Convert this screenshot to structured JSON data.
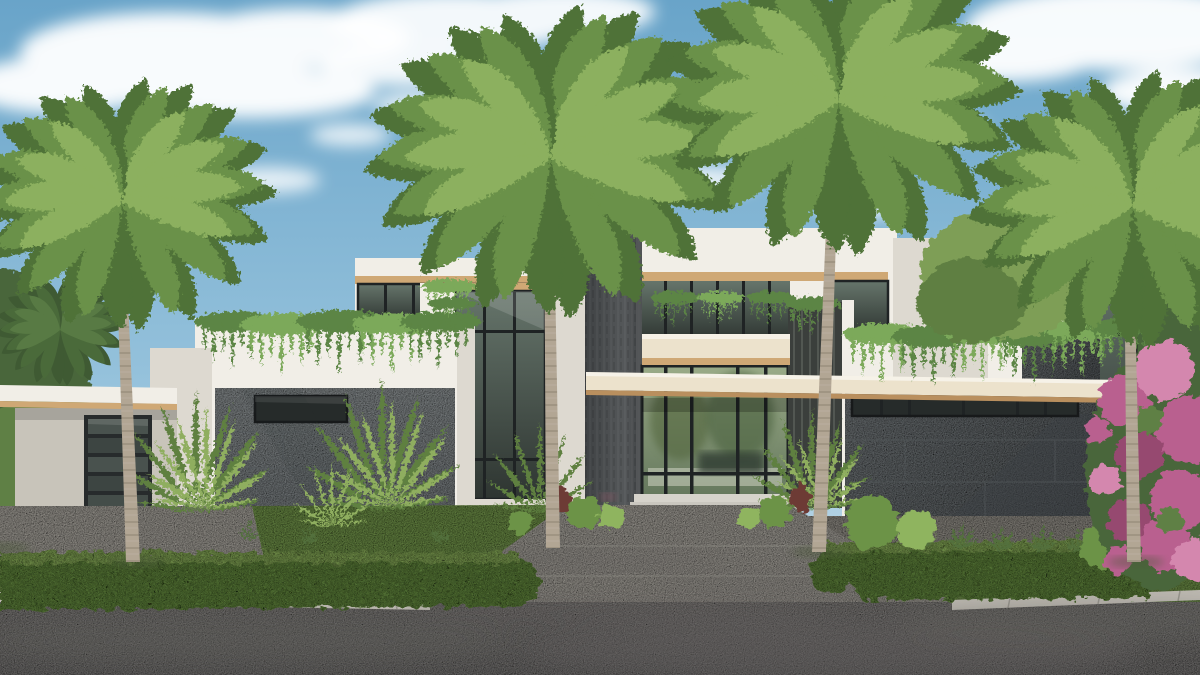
{
  "scene": {
    "type": "architectural-exterior-rendering",
    "description": "Photorealistic 3D rendering of a modern two-story coastal luxury residence with white stucco volumes, gray stone accent walls, a dark central privacy tower, floor-to-ceiling glazing, cream cantilevered canopies, four royal palms, manicured hedges, a central driveway and street in the foreground under a blue sky with scattered clouds.",
    "visible_text": "none",
    "objects": {
      "sky": "blue sky with white cumulus clouds",
      "house": "modern flat-roof two-story residence",
      "privacy_tower": "dark charcoal stone vertical tower at entry",
      "entry_canopy": "long cream cantilevered canopy with wood soffit",
      "balcony": "cream balcony slab over entry glass",
      "garage": "dark glass-paneled garage door under left carport wing",
      "stone_walls": "gray marble-look panel walls left and right",
      "ribbon_window": "horizontal clerestory ribbon window on right wing",
      "glazing": "floor-to-ceiling glass walls with dark mullions",
      "royal_palms": 4,
      "areca_palms": "clusters flanking the left stone wall",
      "vines": "trailing vines over parapets and planters",
      "bougainvillea": "magenta bougainvillea at far right",
      "hedges": "trimmed street hedges left and right",
      "lawn": "manicured lawn",
      "driveway": "light aggregate concrete driveway",
      "street": "asphalt street with palm shadows"
    }
  },
  "palette": {
    "sky_top": "#69a4c9",
    "sky_mid": "#94c1db",
    "sky_low": "#cfe2ec",
    "cloud": "#ffffff",
    "wall_white": "#f1eee7",
    "wall_shade": "#ddd9d0",
    "wall_dark": "#c8c4ba",
    "fascia_cream": "#ece2cc",
    "wood": "#cfa875",
    "wood_dark": "#b98f5e",
    "tower": "#3f4244",
    "tower_light": "#55585a",
    "glass_dark": "#2e3531",
    "glass_light": "#66756b",
    "interior_light": "#9aab88",
    "interior_dark": "#5f7258",
    "mullion": "#1f2324",
    "ribbon_glass": "#262b2a",
    "stone_light": "#9da3a5",
    "stone_mid": "#83898c",
    "stone_dark": "#5f6467",
    "stone_joint": "#565b5e",
    "grass": "#7da253",
    "grass_dark": "#5f8040",
    "hedge": "#6c9346",
    "hedge_light": "#8fb45e",
    "palm_dark": "#4f7238",
    "palm_mid": "#6a9148",
    "palm_light": "#8cb05e",
    "trunk": "#b2a694",
    "crownshaft": "#b5b27b",
    "pave": "#b7b3ab",
    "pave_shade": "#a19d95",
    "street": "#928f8c",
    "street_dark": "#838180",
    "street_shadow": "#63615f",
    "curb": "#bdb9b1",
    "vine": "#5c8544",
    "vine_light": "#7ba95a",
    "areca": "#8fae5f",
    "areca_dark": "#5f8040",
    "agave": "#52703d",
    "bougainvillea": "#b9618f",
    "bougainvillea_dark": "#96486f",
    "bougainvillea_light": "#d487ae",
    "distant_green": "#49663a",
    "mid_green": "#5e8045",
    "shade_tree": "#7e9e57",
    "shade_tree_dark": "#5f7f42"
  }
}
